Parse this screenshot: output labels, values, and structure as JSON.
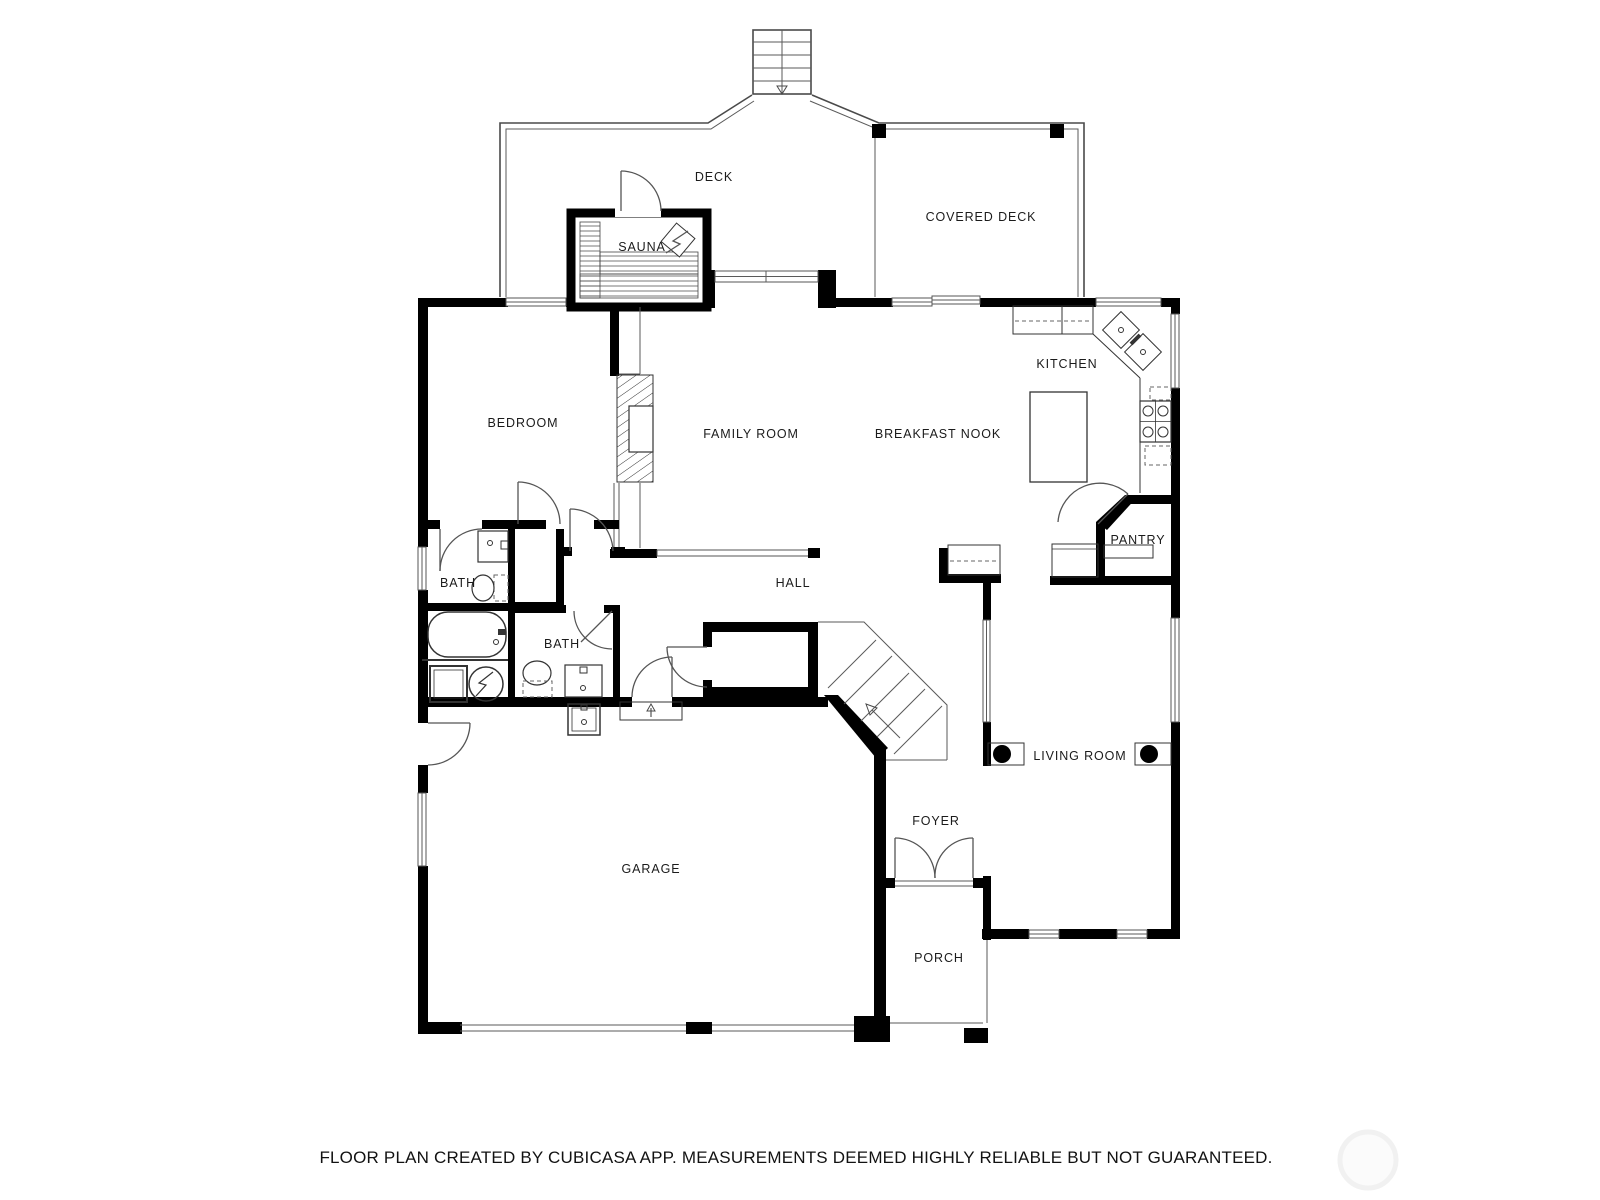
{
  "title": "Floor plan",
  "rooms": {
    "deck": "DECK",
    "covered_deck": "COVERED DECK",
    "sauna": "SAUNA",
    "kitchen": "KITCHEN",
    "breakfast_nook": "BREAKFAST NOOK",
    "family_room": "FAMILY ROOM",
    "bedroom": "BEDROOM",
    "pantry": "PANTRY",
    "bath_upper": "BATH",
    "bath_lower": "BATH",
    "hall": "HALL",
    "living_room": "LIVING ROOM",
    "foyer": "FOYER",
    "garage": "GARAGE",
    "porch": "PORCH"
  },
  "footer": {
    "text": "FLOOR PLAN CREATED BY CUBICASA APP. MEASUREMENTS DEEMED HIGHLY RELIABLE BUT NOT GUARANTEED."
  },
  "colors": {
    "wall": "#000000",
    "thin_line": "#4a4a4a",
    "label_text": "#1b1b1b",
    "background": "#ffffff",
    "watermark": "#f1f1f1"
  }
}
